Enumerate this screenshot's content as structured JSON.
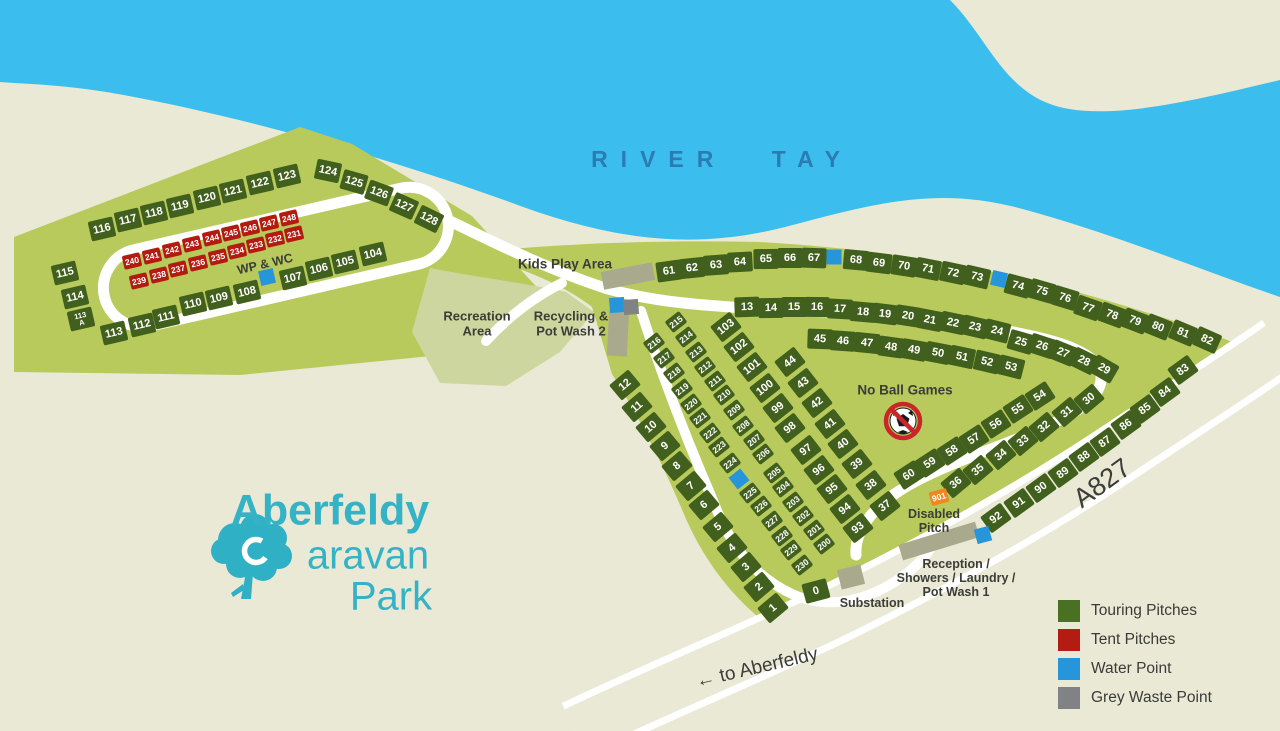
{
  "title": "Aberfeldy Caravan Park",
  "logo": {
    "line1": "Aberfeldy",
    "line2": "Caravan",
    "line3": "Park"
  },
  "legend": {
    "items": [
      {
        "label": "Touring Pitches",
        "color": "#4a7023"
      },
      {
        "label": "Tent Pitches",
        "color": "#b41b12"
      },
      {
        "label": "Water Point",
        "color": "#2795d9"
      },
      {
        "label": "Grey Waste Point",
        "color": "#808285"
      }
    ]
  },
  "colors": {
    "background": "#e9e9d5",
    "river": "#3bbdee",
    "park_green": "#b9ca5d",
    "recreation_green": "#cdd69e",
    "touring_pitch": "#42601d",
    "tent_pitch": "#b31b10",
    "water_point": "#2795d9",
    "grey_waste": "#808285",
    "building": "#a9a98e",
    "disabled_pitch": "#ee8722",
    "road": "#ffffff",
    "label_text": "#3c3c38",
    "river_label": "#2b7cb2",
    "logo_teal": "#35b3c6"
  },
  "map_labels": [
    {
      "id": "river-tay",
      "t": "RIVER TAY",
      "x": 722,
      "y": 160,
      "s": 23,
      "cls": "river"
    },
    {
      "id": "wp-wc",
      "t": "WP & WC",
      "x": 265,
      "y": 264,
      "s": 12.5,
      "r": -13
    },
    {
      "id": "kids-play-area",
      "t": "Kids Play Area",
      "x": 565,
      "y": 264,
      "s": 13.5
    },
    {
      "id": "recreation-area",
      "t": "Recreation\nArea",
      "x": 477,
      "y": 324,
      "s": 13
    },
    {
      "id": "recycling",
      "t": "Recycling &\nPot Wash 2",
      "x": 571,
      "y": 324,
      "s": 13
    },
    {
      "id": "no-ball-games",
      "t": "No Ball Games",
      "x": 905,
      "y": 390,
      "s": 13.5
    },
    {
      "id": "disabled-pitch",
      "t": "Disabled\nPitch",
      "x": 934,
      "y": 521,
      "s": 12.5
    },
    {
      "id": "reception",
      "t": "Reception /\nShowers / Laundry /\nPot Wash 1",
      "x": 956,
      "y": 578,
      "s": 12.5
    },
    {
      "id": "substation",
      "t": "Substation",
      "x": 872,
      "y": 603,
      "s": 12.5
    },
    {
      "id": "a827",
      "t": "A827",
      "x": 1102,
      "y": 483,
      "s": 27,
      "r": -36,
      "cls": "roadname"
    },
    {
      "id": "to-aberfeldy",
      "t": "← to Aberfeldy",
      "x": 757,
      "y": 668,
      "s": 19,
      "r": -13,
      "cls": "roadname"
    }
  ],
  "points": [
    {
      "kind": "water",
      "x": 267,
      "y": 277,
      "r": -13
    },
    {
      "kind": "water",
      "x": 834,
      "y": 257,
      "r": 0
    },
    {
      "kind": "water",
      "x": 999,
      "y": 279,
      "r": 13
    },
    {
      "kind": "water",
      "x": 617,
      "y": 305,
      "r": -5
    },
    {
      "kind": "waste",
      "x": 631,
      "y": 307,
      "r": -5
    },
    {
      "kind": "water",
      "x": 739,
      "y": 479,
      "r": -38
    },
    {
      "kind": "water",
      "x": 983,
      "y": 535,
      "r": -15
    }
  ],
  "pitches": [
    {
      "n": "116",
      "x": 102,
      "y": 229,
      "r": -13
    },
    {
      "n": "117",
      "x": 128,
      "y": 220,
      "r": -13
    },
    {
      "n": "118",
      "x": 154,
      "y": 213,
      "r": -13
    },
    {
      "n": "119",
      "x": 180,
      "y": 206,
      "r": -13
    },
    {
      "n": "120",
      "x": 207,
      "y": 198,
      "r": -13
    },
    {
      "n": "121",
      "x": 233,
      "y": 191,
      "r": -13
    },
    {
      "n": "122",
      "x": 260,
      "y": 183,
      "r": -13
    },
    {
      "n": "123",
      "x": 287,
      "y": 176,
      "r": -13
    },
    {
      "n": "124",
      "x": 328,
      "y": 171,
      "r": 12
    },
    {
      "n": "125",
      "x": 354,
      "y": 182,
      "r": 16
    },
    {
      "n": "126",
      "x": 379,
      "y": 193,
      "r": 20
    },
    {
      "n": "127",
      "x": 404,
      "y": 206,
      "r": 24
    },
    {
      "n": "128",
      "x": 429,
      "y": 219,
      "r": 26
    },
    {
      "n": "115",
      "x": 65,
      "y": 273,
      "r": -13
    },
    {
      "n": "114",
      "x": 75,
      "y": 297,
      "r": -13
    },
    {
      "n": "113\nA",
      "x": 81,
      "y": 319,
      "r": -13
    },
    {
      "n": "113",
      "x": 114,
      "y": 333,
      "r": -13
    },
    {
      "n": "112",
      "x": 142,
      "y": 325,
      "r": -13
    },
    {
      "n": "111",
      "x": 166,
      "y": 317,
      "r": -13
    },
    {
      "n": "110",
      "x": 193,
      "y": 304,
      "r": -13
    },
    {
      "n": "109",
      "x": 219,
      "y": 298,
      "r": -13
    },
    {
      "n": "108",
      "x": 247,
      "y": 292,
      "r": -13
    },
    {
      "n": "107",
      "x": 293,
      "y": 278,
      "r": -13
    },
    {
      "n": "106",
      "x": 319,
      "y": 269,
      "r": -13
    },
    {
      "n": "105",
      "x": 345,
      "y": 262,
      "r": -13
    },
    {
      "n": "104",
      "x": 373,
      "y": 254,
      "r": -13
    },
    {
      "n": "240",
      "x": 132,
      "y": 261,
      "r": -13,
      "t": "r",
      "z": "s"
    },
    {
      "n": "241",
      "x": 152,
      "y": 256,
      "r": -13,
      "t": "r",
      "z": "s"
    },
    {
      "n": "242",
      "x": 172,
      "y": 250,
      "r": -13,
      "t": "r",
      "z": "s"
    },
    {
      "n": "243",
      "x": 192,
      "y": 244,
      "r": -13,
      "t": "r",
      "z": "s"
    },
    {
      "n": "244",
      "x": 212,
      "y": 238,
      "r": -13,
      "t": "r",
      "z": "s"
    },
    {
      "n": "245",
      "x": 231,
      "y": 233,
      "r": -13,
      "t": "r",
      "z": "s"
    },
    {
      "n": "246",
      "x": 250,
      "y": 228,
      "r": -13,
      "t": "r",
      "z": "s"
    },
    {
      "n": "247",
      "x": 269,
      "y": 223,
      "r": -13,
      "t": "r",
      "z": "s"
    },
    {
      "n": "248",
      "x": 289,
      "y": 218,
      "r": -13,
      "t": "r",
      "z": "s"
    },
    {
      "n": "239",
      "x": 139,
      "y": 281,
      "r": -13,
      "t": "r",
      "z": "s"
    },
    {
      "n": "238",
      "x": 159,
      "y": 275,
      "r": -13,
      "t": "r",
      "z": "s"
    },
    {
      "n": "237",
      "x": 178,
      "y": 269,
      "r": -13,
      "t": "r",
      "z": "s"
    },
    {
      "n": "236",
      "x": 198,
      "y": 263,
      "r": -13,
      "t": "r",
      "z": "s"
    },
    {
      "n": "235",
      "x": 218,
      "y": 257,
      "r": -13,
      "t": "r",
      "z": "s"
    },
    {
      "n": "234",
      "x": 237,
      "y": 251,
      "r": -13,
      "t": "r",
      "z": "s"
    },
    {
      "n": "233",
      "x": 256,
      "y": 245,
      "r": -13,
      "t": "r",
      "z": "s"
    },
    {
      "n": "232",
      "x": 275,
      "y": 239,
      "r": -13,
      "t": "r",
      "z": "s"
    },
    {
      "n": "231",
      "x": 294,
      "y": 234,
      "r": -13,
      "t": "r",
      "z": "s"
    },
    {
      "n": "61",
      "x": 669,
      "y": 271,
      "r": -8
    },
    {
      "n": "62",
      "x": 692,
      "y": 268,
      "r": -6
    },
    {
      "n": "63",
      "x": 716,
      "y": 265,
      "r": -4
    },
    {
      "n": "64",
      "x": 740,
      "y": 262,
      "r": -3
    },
    {
      "n": "65",
      "x": 766,
      "y": 259,
      "r": -1
    },
    {
      "n": "66",
      "x": 790,
      "y": 258,
      "r": 0
    },
    {
      "n": "67",
      "x": 814,
      "y": 258,
      "r": 2
    },
    {
      "n": "68",
      "x": 856,
      "y": 260,
      "r": 5
    },
    {
      "n": "69",
      "x": 879,
      "y": 263,
      "r": 7
    },
    {
      "n": "70",
      "x": 904,
      "y": 266,
      "r": 9
    },
    {
      "n": "71",
      "x": 928,
      "y": 269,
      "r": 11
    },
    {
      "n": "72",
      "x": 953,
      "y": 273,
      "r": 12
    },
    {
      "n": "73",
      "x": 977,
      "y": 277,
      "r": 13
    },
    {
      "n": "74",
      "x": 1018,
      "y": 286,
      "r": 15
    },
    {
      "n": "75",
      "x": 1042,
      "y": 291,
      "r": 16
    },
    {
      "n": "76",
      "x": 1065,
      "y": 298,
      "r": 17
    },
    {
      "n": "77",
      "x": 1088,
      "y": 308,
      "r": 19
    },
    {
      "n": "78",
      "x": 1112,
      "y": 315,
      "r": 20
    },
    {
      "n": "79",
      "x": 1135,
      "y": 321,
      "r": 21
    },
    {
      "n": "80",
      "x": 1158,
      "y": 327,
      "r": 22
    },
    {
      "n": "81",
      "x": 1183,
      "y": 333,
      "r": 23
    },
    {
      "n": "82",
      "x": 1207,
      "y": 340,
      "r": 24
    },
    {
      "n": "13",
      "x": 747,
      "y": 307,
      "r": -2
    },
    {
      "n": "14",
      "x": 771,
      "y": 308,
      "r": -1
    },
    {
      "n": "15",
      "x": 794,
      "y": 307,
      "r": 0
    },
    {
      "n": "16",
      "x": 817,
      "y": 307,
      "r": 1
    },
    {
      "n": "17",
      "x": 840,
      "y": 309,
      "r": 3
    },
    {
      "n": "18",
      "x": 863,
      "y": 312,
      "r": 5
    },
    {
      "n": "19",
      "x": 885,
      "y": 314,
      "r": 7
    },
    {
      "n": "20",
      "x": 908,
      "y": 316,
      "r": 9
    },
    {
      "n": "21",
      "x": 930,
      "y": 320,
      "r": 11
    },
    {
      "n": "22",
      "x": 953,
      "y": 323,
      "r": 12
    },
    {
      "n": "23",
      "x": 975,
      "y": 327,
      "r": 13
    },
    {
      "n": "24",
      "x": 997,
      "y": 331,
      "r": 14
    },
    {
      "n": "25",
      "x": 1021,
      "y": 342,
      "r": 16
    },
    {
      "n": "26",
      "x": 1042,
      "y": 346,
      "r": 18
    },
    {
      "n": "27",
      "x": 1063,
      "y": 353,
      "r": 22
    },
    {
      "n": "28",
      "x": 1084,
      "y": 361,
      "r": 26
    },
    {
      "n": "29",
      "x": 1104,
      "y": 369,
      "r": 30
    },
    {
      "n": "45",
      "x": 820,
      "y": 339,
      "r": 2
    },
    {
      "n": "46",
      "x": 843,
      "y": 341,
      "r": 4
    },
    {
      "n": "47",
      "x": 867,
      "y": 343,
      "r": 6
    },
    {
      "n": "48",
      "x": 891,
      "y": 347,
      "r": 8
    },
    {
      "n": "49",
      "x": 914,
      "y": 350,
      "r": 10
    },
    {
      "n": "50",
      "x": 938,
      "y": 353,
      "r": 11
    },
    {
      "n": "51",
      "x": 962,
      "y": 357,
      "r": 12
    },
    {
      "n": "52",
      "x": 987,
      "y": 362,
      "r": 13
    },
    {
      "n": "53",
      "x": 1011,
      "y": 367,
      "r": 14
    },
    {
      "n": "44",
      "x": 790,
      "y": 362,
      "r": -38
    },
    {
      "n": "43",
      "x": 803,
      "y": 383,
      "r": -38
    },
    {
      "n": "42",
      "x": 817,
      "y": 403,
      "r": -38
    },
    {
      "n": "41",
      "x": 830,
      "y": 424,
      "r": -38
    },
    {
      "n": "40",
      "x": 843,
      "y": 444,
      "r": -38
    },
    {
      "n": "39",
      "x": 857,
      "y": 464,
      "r": -38
    },
    {
      "n": "38",
      "x": 871,
      "y": 485,
      "r": -38
    },
    {
      "n": "37",
      "x": 885,
      "y": 506,
      "r": -38
    },
    {
      "n": "54",
      "x": 1040,
      "y": 396,
      "r": -33
    },
    {
      "n": "55",
      "x": 1018,
      "y": 409,
      "r": -33
    },
    {
      "n": "56",
      "x": 996,
      "y": 424,
      "r": -33
    },
    {
      "n": "57",
      "x": 974,
      "y": 439,
      "r": -33
    },
    {
      "n": "58",
      "x": 952,
      "y": 451,
      "r": -33
    },
    {
      "n": "59",
      "x": 930,
      "y": 463,
      "r": -33
    },
    {
      "n": "60",
      "x": 909,
      "y": 475,
      "r": -33
    },
    {
      "n": "30",
      "x": 1089,
      "y": 399,
      "r": -40
    },
    {
      "n": "31",
      "x": 1067,
      "y": 412,
      "r": -40
    },
    {
      "n": "32",
      "x": 1044,
      "y": 427,
      "r": -40
    },
    {
      "n": "33",
      "x": 1023,
      "y": 441,
      "r": -40
    },
    {
      "n": "34",
      "x": 1001,
      "y": 455,
      "r": -40
    },
    {
      "n": "35",
      "x": 978,
      "y": 470,
      "r": -40
    },
    {
      "n": "36",
      "x": 956,
      "y": 483,
      "r": -40
    },
    {
      "n": "83",
      "x": 1183,
      "y": 370,
      "r": -36
    },
    {
      "n": "84",
      "x": 1165,
      "y": 392,
      "r": -36
    },
    {
      "n": "85",
      "x": 1145,
      "y": 409,
      "r": -36
    },
    {
      "n": "86",
      "x": 1126,
      "y": 425,
      "r": -36
    },
    {
      "n": "87",
      "x": 1105,
      "y": 442,
      "r": -36
    },
    {
      "n": "88",
      "x": 1084,
      "y": 457,
      "r": -36
    },
    {
      "n": "89",
      "x": 1063,
      "y": 473,
      "r": -36
    },
    {
      "n": "90",
      "x": 1041,
      "y": 488,
      "r": -36
    },
    {
      "n": "91",
      "x": 1019,
      "y": 503,
      "r": -36
    },
    {
      "n": "92",
      "x": 996,
      "y": 518,
      "r": -36
    },
    {
      "n": "103",
      "x": 726,
      "y": 327,
      "r": -38
    },
    {
      "n": "102",
      "x": 739,
      "y": 347,
      "r": -38
    },
    {
      "n": "101",
      "x": 752,
      "y": 367,
      "r": -38
    },
    {
      "n": "100",
      "x": 765,
      "y": 388,
      "r": -38
    },
    {
      "n": "99",
      "x": 778,
      "y": 408,
      "r": -38
    },
    {
      "n": "98",
      "x": 790,
      "y": 428,
      "r": -38
    },
    {
      "n": "97",
      "x": 806,
      "y": 450,
      "r": -38
    },
    {
      "n": "96",
      "x": 819,
      "y": 470,
      "r": -38
    },
    {
      "n": "95",
      "x": 832,
      "y": 489,
      "r": -38
    },
    {
      "n": "94",
      "x": 845,
      "y": 509,
      "r": -38
    },
    {
      "n": "93",
      "x": 858,
      "y": 528,
      "r": -38
    },
    {
      "n": "12",
      "x": 625,
      "y": 385,
      "r": -40
    },
    {
      "n": "11",
      "x": 637,
      "y": 407,
      "r": -40
    },
    {
      "n": "10",
      "x": 651,
      "y": 427,
      "r": -40
    },
    {
      "n": "9",
      "x": 665,
      "y": 446,
      "r": -40
    },
    {
      "n": "8",
      "x": 677,
      "y": 466,
      "r": -40
    },
    {
      "n": "7",
      "x": 691,
      "y": 486,
      "r": -40
    },
    {
      "n": "6",
      "x": 704,
      "y": 505,
      "r": -40
    },
    {
      "n": "5",
      "x": 718,
      "y": 527,
      "r": -40
    },
    {
      "n": "4",
      "x": 732,
      "y": 548,
      "r": -40
    },
    {
      "n": "3",
      "x": 746,
      "y": 567,
      "r": -40
    },
    {
      "n": "2",
      "x": 759,
      "y": 587,
      "r": -40
    },
    {
      "n": "1",
      "x": 773,
      "y": 608,
      "r": -40
    },
    {
      "n": "0",
      "x": 816,
      "y": 591,
      "r": -15
    },
    {
      "n": "216",
      "x": 654,
      "y": 343,
      "r": -38,
      "z": "s"
    },
    {
      "n": "217",
      "x": 664,
      "y": 358,
      "r": -38,
      "z": "s"
    },
    {
      "n": "218",
      "x": 674,
      "y": 373,
      "r": -38,
      "z": "s"
    },
    {
      "n": "219",
      "x": 682,
      "y": 389,
      "r": -38,
      "z": "s"
    },
    {
      "n": "220",
      "x": 691,
      "y": 404,
      "r": -38,
      "z": "s"
    },
    {
      "n": "221",
      "x": 700,
      "y": 418,
      "r": -38,
      "z": "s"
    },
    {
      "n": "222",
      "x": 710,
      "y": 433,
      "r": -38,
      "z": "s"
    },
    {
      "n": "223",
      "x": 719,
      "y": 447,
      "r": -38,
      "z": "s"
    },
    {
      "n": "224",
      "x": 730,
      "y": 463,
      "r": -38,
      "z": "s"
    },
    {
      "n": "225",
      "x": 750,
      "y": 493,
      "r": -38,
      "z": "s"
    },
    {
      "n": "226",
      "x": 761,
      "y": 506,
      "r": -38,
      "z": "s"
    },
    {
      "n": "227",
      "x": 772,
      "y": 521,
      "r": -38,
      "z": "s"
    },
    {
      "n": "228",
      "x": 782,
      "y": 536,
      "r": -38,
      "z": "s"
    },
    {
      "n": "229",
      "x": 791,
      "y": 550,
      "r": -38,
      "z": "s"
    },
    {
      "n": "230",
      "x": 802,
      "y": 565,
      "r": -38,
      "z": "s"
    },
    {
      "n": "215",
      "x": 676,
      "y": 322,
      "r": -38,
      "z": "s"
    },
    {
      "n": "214",
      "x": 686,
      "y": 337,
      "r": -38,
      "z": "s"
    },
    {
      "n": "213",
      "x": 696,
      "y": 352,
      "r": -38,
      "z": "s"
    },
    {
      "n": "212",
      "x": 705,
      "y": 367,
      "r": -38,
      "z": "s"
    },
    {
      "n": "211",
      "x": 715,
      "y": 381,
      "r": -38,
      "z": "s"
    },
    {
      "n": "210",
      "x": 724,
      "y": 395,
      "r": -38,
      "z": "s"
    },
    {
      "n": "209",
      "x": 734,
      "y": 410,
      "r": -38,
      "z": "s"
    },
    {
      "n": "208",
      "x": 743,
      "y": 426,
      "r": -38,
      "z": "s"
    },
    {
      "n": "207",
      "x": 754,
      "y": 440,
      "r": -38,
      "z": "s"
    },
    {
      "n": "206",
      "x": 763,
      "y": 454,
      "r": -38,
      "z": "s"
    },
    {
      "n": "205",
      "x": 774,
      "y": 473,
      "r": -38,
      "z": "s"
    },
    {
      "n": "204",
      "x": 783,
      "y": 487,
      "r": -38,
      "z": "s"
    },
    {
      "n": "203",
      "x": 793,
      "y": 502,
      "r": -38,
      "z": "s"
    },
    {
      "n": "202",
      "x": 803,
      "y": 516,
      "r": -38,
      "z": "s"
    },
    {
      "n": "201",
      "x": 814,
      "y": 530,
      "r": -38,
      "z": "s"
    },
    {
      "n": "200",
      "x": 824,
      "y": 544,
      "r": -38,
      "z": "s"
    },
    {
      "n": "901",
      "x": 939,
      "y": 497,
      "r": -15,
      "t": "o",
      "z": "s"
    }
  ]
}
